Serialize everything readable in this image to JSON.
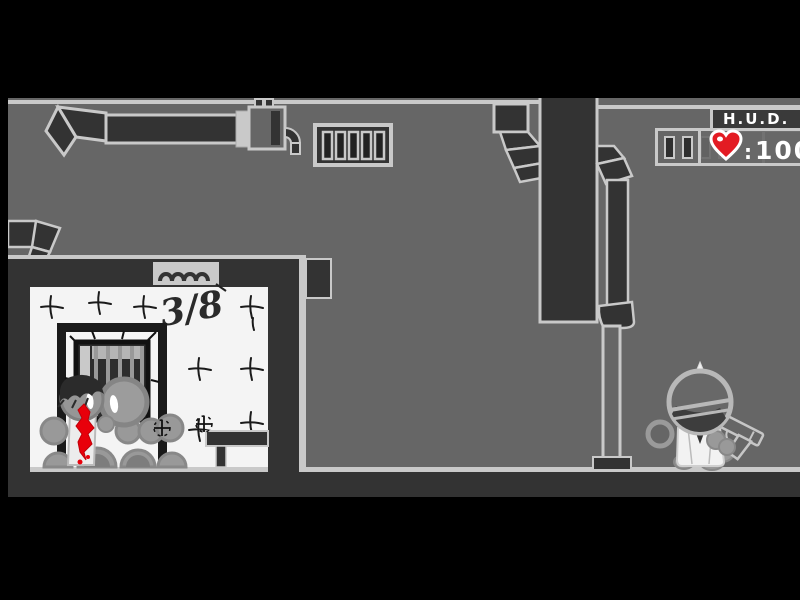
{
  "hud": {
    "title": "H.U.D.",
    "health": {
      "separator": ":",
      "value": "100",
      "icon": "heart-icon"
    },
    "ammo_clip": {
      "icon": "ammo-clip-icon",
      "slots_visible": 4
    }
  },
  "scene": {
    "wall_text": "3/8",
    "door_sign": {
      "icon": "squiggle-sign-icon"
    },
    "objects": [
      "ceiling-duct",
      "duct-elbow",
      "wall-vent-grille",
      "dark-pillar",
      "drain-pipe",
      "white-tiled-alcove",
      "barred-window",
      "door-frame",
      "wall-bench",
      "corpse-pile",
      "blood-splatter",
      "player-character",
      "pistol"
    ]
  },
  "colors": {
    "frame_black": "#000000",
    "wall_gray": "#666666",
    "dark_structure": "#333333",
    "outline_light": "#c9c9c9",
    "room_white": "#f4f4f4",
    "body_gray": "#999999",
    "blood_red": "#e8000b",
    "heart_red": "#e31b23",
    "hud_text": "#ffffff"
  }
}
